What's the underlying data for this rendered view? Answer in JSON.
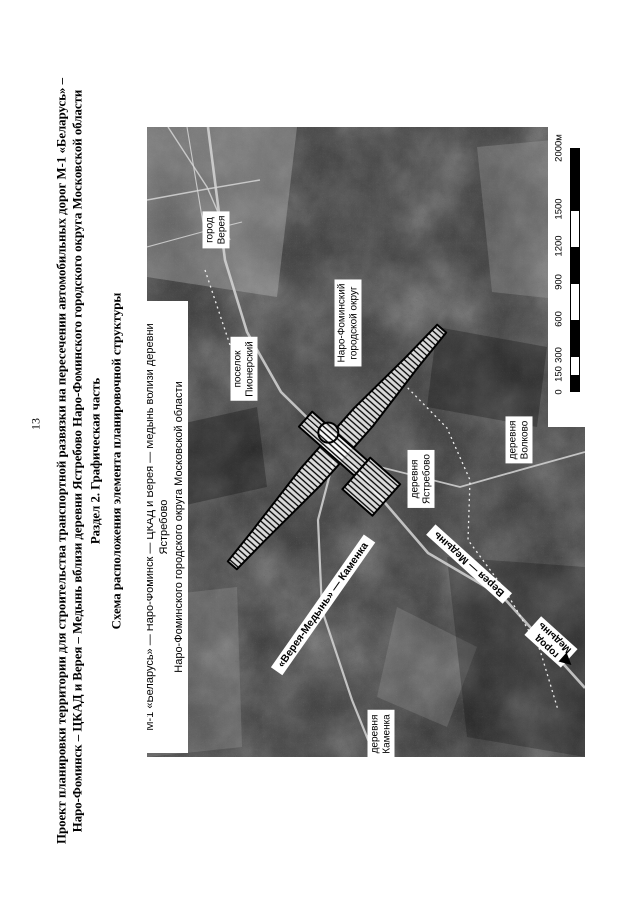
{
  "page": {
    "number": "13"
  },
  "header": {
    "line1": "Проект планировки территории для строительства транспортной развязки на пересечении автомобильных дорог М-1 «Беларусь» –",
    "line2": "Наро-Фоминск – ЦКАД и Верея – Медынь вблизи деревни Ястребово Наро-Фоминского городского округа Московской области",
    "line3": "Раздел 2. Графическая часть",
    "line4": "Схема расположения элемента планировочной структуры"
  },
  "map": {
    "title": {
      "line1": "Участок строительства транспортной развязки на пересечении автомобильных дорог",
      "line2": "М-1 «Беларусь» — Наро-Фоминск — ЦКАД и Верея — Медынь вблизи деревни Ястребово",
      "line3": "Наро-Фоминского городского округа Московской области"
    },
    "place_labels": {
      "gorod_vereya": {
        "line1": "город",
        "line2": "Верея"
      },
      "poselok_pionerskiy": {
        "line1": "поселок",
        "line2": "Пионерский"
      },
      "naro_fominskiy_okrug": {
        "line1": "Наро-Фоминский",
        "line2": "городской округ"
      },
      "derevnya_yastrebovo": {
        "line1": "деревня",
        "line2": "Ястребово"
      },
      "derevnya_volkovo": {
        "line1": "деревня",
        "line2": "Волково"
      },
      "derevnya_kamenka": {
        "line1": "деревня",
        "line2": "Каменка"
      },
      "gorod_medyn": {
        "line1": "город",
        "line2": "Медынь"
      }
    },
    "road_labels": {
      "vereya_medyn_kamenka": "«Верея-Медынь» — Каменка",
      "vereya_medyn": "Верея — Медынь"
    },
    "scale": {
      "ticks": [
        "0",
        "150",
        "300",
        "600",
        "900",
        "1200",
        "1500",
        "2000м"
      ]
    },
    "colors": {
      "paper": "#ffffff",
      "ink": "#000000",
      "label_bg": "#ffffff"
    }
  }
}
